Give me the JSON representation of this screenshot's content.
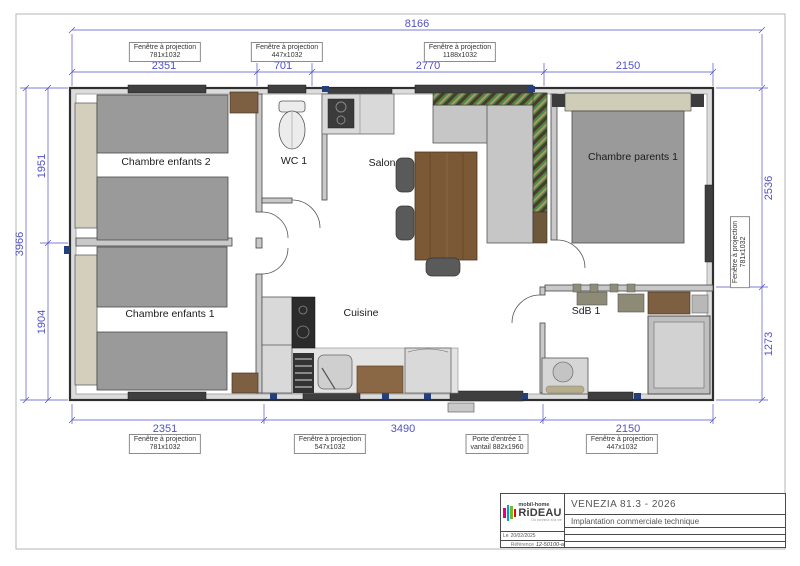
{
  "colors": {
    "dimension": "#5252c6",
    "wall_outline": "#2f2f2f",
    "wood": "#7b5836",
    "bed": "#9a9a9a",
    "headboard": "#d3cfbc",
    "sofa_green": "#4f8a44",
    "logo_magenta": "#e6007e",
    "logo_blue": "#009ee0",
    "logo_green": "#76b82a",
    "logo_red": "#e30613"
  },
  "plan": {
    "rooms": [
      {
        "name": "Chambre enfants 2"
      },
      {
        "name": "WC 1"
      },
      {
        "name": "Salon"
      },
      {
        "name": "Chambre parents 1"
      },
      {
        "name": "Chambre enfants 1"
      },
      {
        "name": "Cuisine"
      },
      {
        "name": "SdB 1"
      }
    ],
    "dimensions": {
      "overall_width": "8166",
      "overall_depth": "3966",
      "top": [
        "2351",
        "701",
        "2770",
        "2150"
      ],
      "left": [
        "1951",
        "1904"
      ],
      "right": [
        "2536",
        "1273"
      ],
      "bottom": [
        "2351",
        "3490",
        "2150"
      ],
      "wc_depth": "1107"
    },
    "openings": {
      "top": [
        {
          "line1": "Fenêtre à projection",
          "line2": "781x1032"
        },
        {
          "line1": "Fenêtre à projection",
          "line2": "447x1032"
        },
        {
          "line1": "Fenêtre à projection",
          "line2": "1188x1032"
        }
      ],
      "bottom": [
        {
          "line1": "Fenêtre à projection",
          "line2": "781x1032"
        },
        {
          "line1": "Fenêtre à projection",
          "line2": "547x1032"
        },
        {
          "line1": "Porte d'entrée 1",
          "line2": "vantail 882x1960"
        },
        {
          "line1": "Fenêtre à projection",
          "line2": "447x1032"
        }
      ],
      "right": {
        "line1": "Fenêtre à projection",
        "line2": "781x1032"
      }
    }
  },
  "title_block": {
    "logo": {
      "top": "mobil-home",
      "name": "RiDEAU",
      "tagline": "Du bonheur à la vie"
    },
    "title": "VENEZIA 81.3 - 2026",
    "subtitle": "Implantation commerciale technique",
    "date_label": "Le",
    "date": "20/02/2025",
    "reference_label": "Référence",
    "reference": "12-50100-a"
  }
}
